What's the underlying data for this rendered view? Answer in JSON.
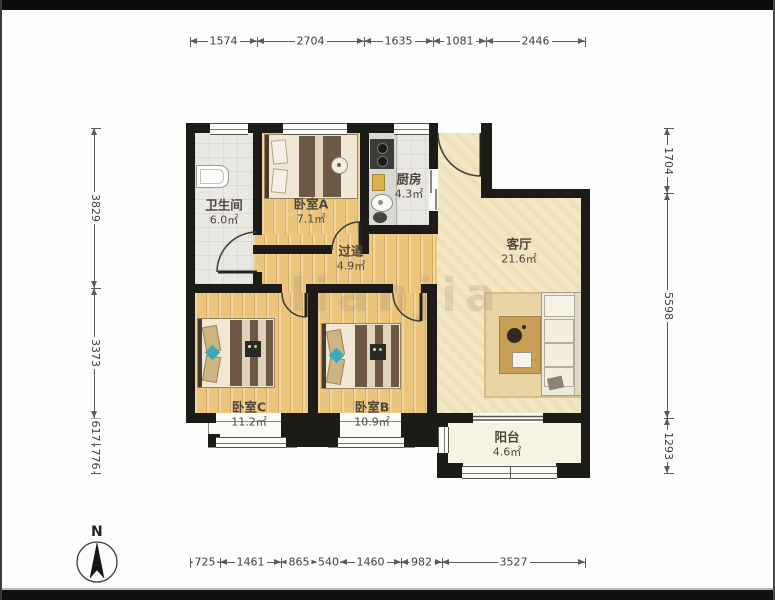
{
  "compass": {
    "label": "N"
  },
  "watermark": "lianjia",
  "rooms": [
    {
      "name": "卫生间",
      "area": "6.0㎡"
    },
    {
      "name": "卧室A",
      "area": "7.1㎡"
    },
    {
      "name": "厨房",
      "area": "4.3㎡"
    },
    {
      "name": "过道",
      "area": "4.9㎡"
    },
    {
      "name": "客厅",
      "area": "21.6㎡"
    },
    {
      "name": "卧室C",
      "area": "11.2㎡"
    },
    {
      "name": "卧室B",
      "area": "10.9㎡"
    },
    {
      "name": "阳台",
      "area": "4.6㎡"
    }
  ],
  "dimensions": {
    "top": [
      "1574",
      "2704",
      "1635",
      "1081",
      "2446"
    ],
    "bottom": [
      "725",
      "1461",
      "865",
      "540",
      "1460",
      "982",
      "3527"
    ],
    "left": [
      "3829",
      "3373",
      "617",
      "776"
    ],
    "right": [
      "1704",
      "5598",
      "1293"
    ]
  },
  "colors": {
    "wall": "#1d1b18",
    "wood_floor": "#ecc57c",
    "tile_floor": "#eae8e3",
    "living_floor": "#f4e7c3",
    "balcony_floor": "#f7f3e2",
    "accent_teal": "#3ba9bd"
  }
}
